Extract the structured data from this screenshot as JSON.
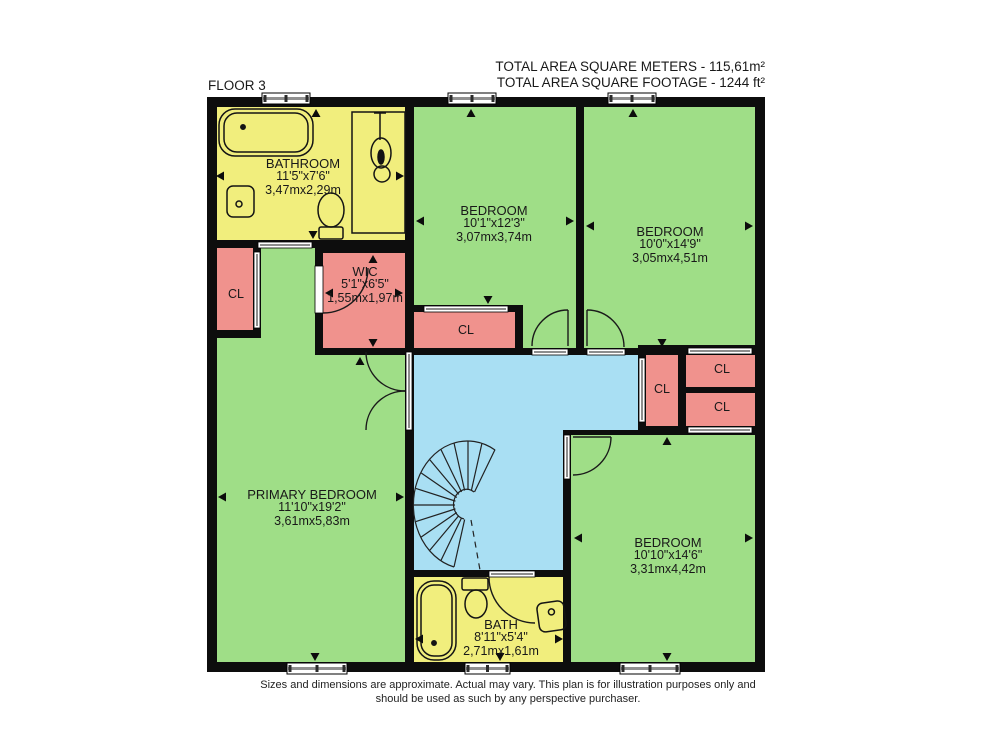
{
  "header": {
    "floor_label": "FLOOR 3",
    "total_meters": "TOTAL AREA SQUARE METERS - 115,61m²",
    "total_footage": "TOTAL AREA SQUARE FOOTAGE - 1244 ft²"
  },
  "rooms": [
    {
      "id": "bathroom",
      "name": "BATHROOM",
      "dims_ft": "11'5\"x7'6\"",
      "dims_m": "3,47mx2,29m"
    },
    {
      "id": "bedroom-top-center",
      "name": "BEDROOM",
      "dims_ft": "10'1\"x12'3\"",
      "dims_m": "3,07mx3,74m"
    },
    {
      "id": "bedroom-top-right",
      "name": "BEDROOM",
      "dims_ft": "10'0\"x14'9\"",
      "dims_m": "3,05mx4,51m"
    },
    {
      "id": "wic",
      "name": "WIC",
      "dims_ft": "5'1\"x6'5\"",
      "dims_m": "1,55mx1,97m"
    },
    {
      "id": "primary-bedroom",
      "name": "PRIMARY BEDROOM",
      "dims_ft": "11'10\"x19'2\"",
      "dims_m": "3,61mx5,83m"
    },
    {
      "id": "bedroom-bottom-right",
      "name": "BEDROOM",
      "dims_ft": "10'10\"x14'6\"",
      "dims_m": "3,31mx4,42m"
    },
    {
      "id": "bath",
      "name": "BATH",
      "dims_ft": "8'11\"x5'4\"",
      "dims_m": "2,71mx1,61m"
    }
  ],
  "closet_label": "CL",
  "footer": {
    "line1": "Sizes and dimensions are approximate. Actual may vary. This plan is for illustration purposes only and",
    "line2": "should be used as such by any perspective purchaser."
  },
  "colors": {
    "room_green": "#9FDE87",
    "room_yellow": "#F1EE7D",
    "closet_pink": "#F0928D",
    "hall_blue": "#A9DFF3",
    "wall": "#0D0D0D"
  }
}
